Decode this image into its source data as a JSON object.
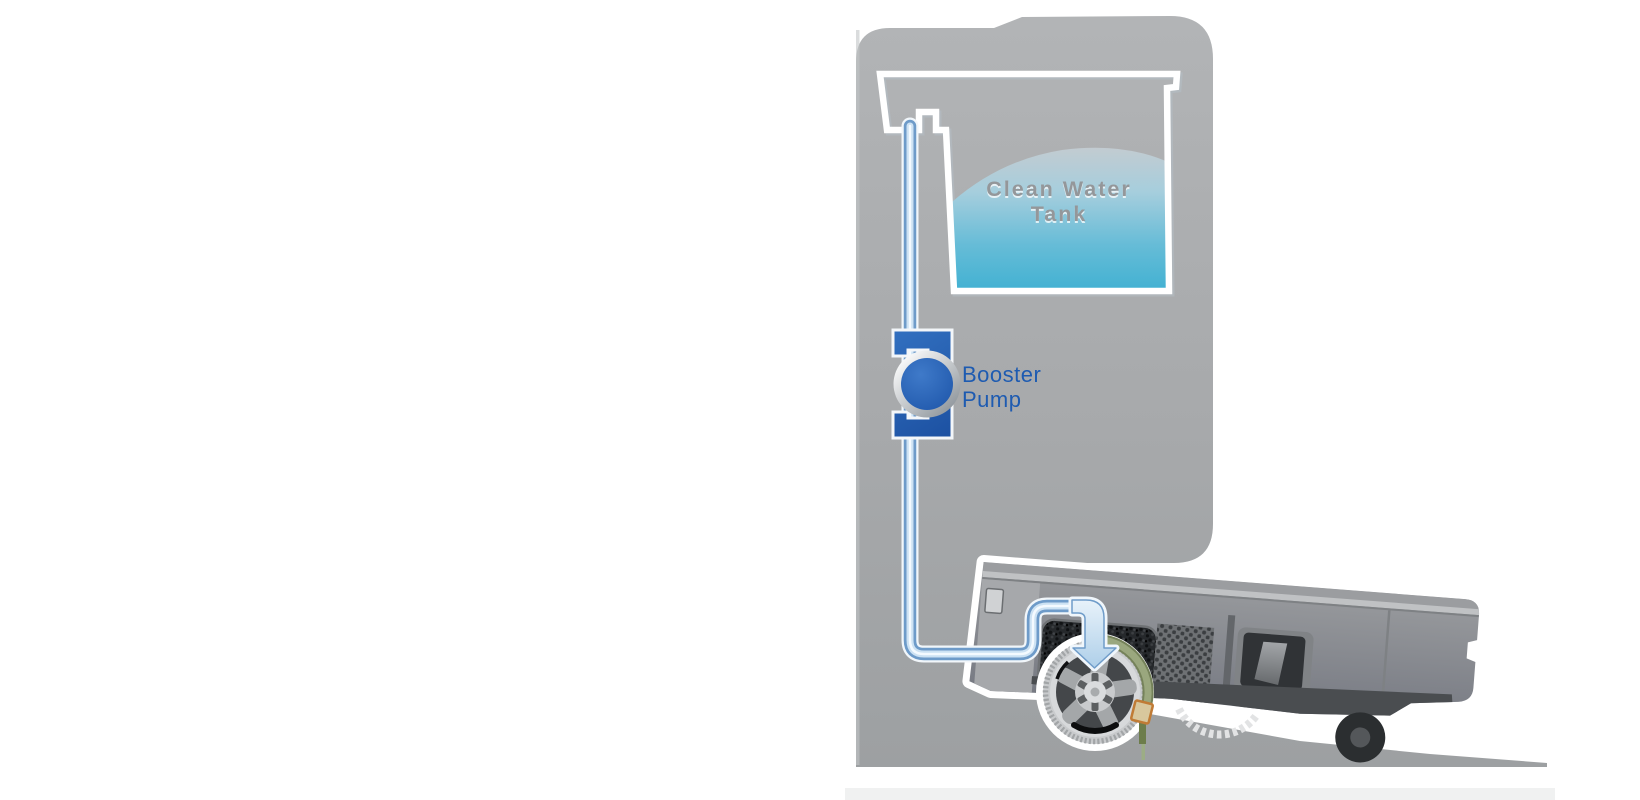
{
  "diagram": {
    "labels": {
      "tank_line1": "Clean Water",
      "tank_line2": "Tank",
      "pump_line1": "Booster",
      "pump_line2": "Pump"
    },
    "colors": {
      "background": "#ffffff",
      "dock_gray": "#a8aaac",
      "ramp_gray": "#b0b3b5",
      "water_top": "#c4cbd0",
      "water_bottom": "#41b1d2",
      "tank_outline": "#ffffff",
      "tank_label_gray": "#94979a",
      "tube_edge_blue": "#6e9bc9",
      "tube_core_blue": "#cde2f3",
      "arrow_blue": "#b2d2ea",
      "pump_blue": "#2166b8",
      "label_blue": "#1e5bb1",
      "robot_body_gray": "#8f9194",
      "robot_dark_panel": "#3a3d40",
      "robot_outline": "#ffffff",
      "brush_green": "#8e9c72",
      "scraper_orange": "#c07b35"
    },
    "icons": [
      "clean-water-tank",
      "booster-pump",
      "water-tube",
      "flow-arrow",
      "robot-vacuum",
      "roller-brush-wheel"
    ]
  }
}
